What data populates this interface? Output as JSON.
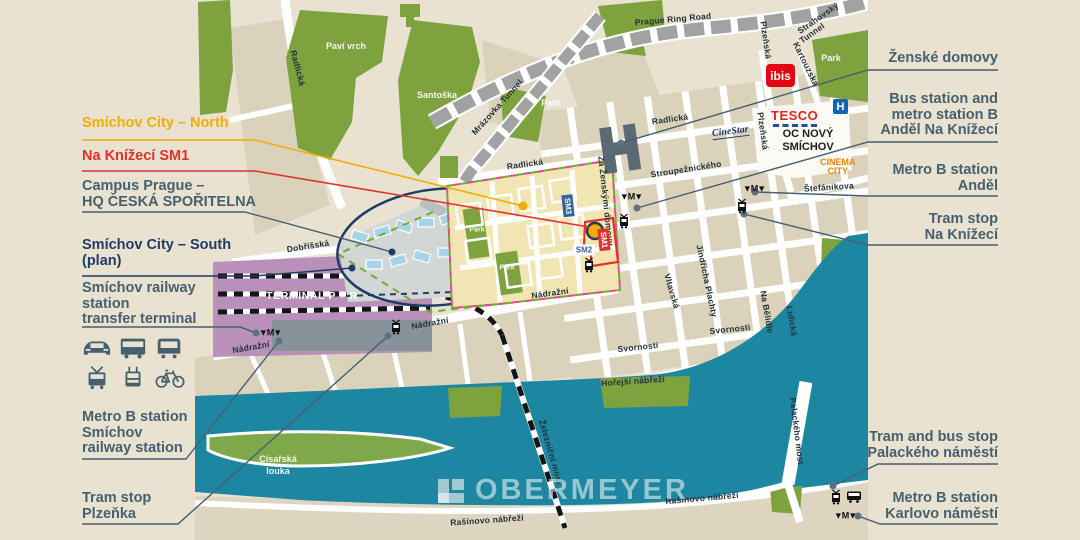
{
  "canvas": {
    "bg": "#e9e2d1"
  },
  "watermark": {
    "text": "OBERMEYER"
  },
  "colors": {
    "slate": "#46606f",
    "navy": "#1e3c64",
    "yellow": "#f0ad00",
    "red": "#e0312d",
    "river": "#1d87a2",
    "park": "#7da23e",
    "terminal": "#b890ba",
    "dev_area": "#f2e5b4"
  },
  "callouts": {
    "left": [
      {
        "id": "smichov-city-north",
        "lines": [
          "Smíchov City – North"
        ],
        "color": "#f0ad00",
        "y": 116
      },
      {
        "id": "na-knizeci-sm1",
        "lines": [
          "Na Knížecí SM1"
        ],
        "color": "#e0312d",
        "y": 149
      },
      {
        "id": "campus-prague",
        "lines": [
          "Campus Prague –",
          "HQ ČESKÁ SPOŘITELNA"
        ],
        "color": "#46606f",
        "y": 179
      },
      {
        "id": "smichov-city-south",
        "lines": [
          "Smíchov City – South",
          "(plan)"
        ],
        "color": "#1e3c64",
        "y": 238
      },
      {
        "id": "smichov-transfer-terminal",
        "lines": [
          "Smíchov railway",
          "station",
          "transfer terminal"
        ],
        "color": "#46606f",
        "y": 281
      },
      {
        "id": "metro-b-smichov",
        "lines": [
          "Metro B station",
          "Smíchov",
          "railway station"
        ],
        "color": "#46606f",
        "y": 410
      },
      {
        "id": "tram-stop-plzenka",
        "lines": [
          "Tram stop",
          "Plzeňka"
        ],
        "color": "#46606f",
        "y": 491
      }
    ],
    "right": [
      {
        "id": "zenske-domovy",
        "lines": [
          "Ženské domovy"
        ],
        "color": "#46606f",
        "y": 51
      },
      {
        "id": "bus-metro-andel-na-knizeci",
        "lines": [
          "Bus station and",
          "metro station B",
          "Anděl Na Knížecí"
        ],
        "color": "#46606f",
        "y": 92
      },
      {
        "id": "metro-b-andel",
        "lines": [
          "Metro B station",
          "Anděl"
        ],
        "color": "#46606f",
        "y": 163
      },
      {
        "id": "tram-stop-na-knizeci",
        "lines": [
          "Tram stop",
          "Na Knížecí"
        ],
        "color": "#46606f",
        "y": 212
      },
      {
        "id": "tram-bus-palackeho",
        "lines": [
          "Tram and bus stop",
          "Palackého náměstí"
        ],
        "color": "#46606f",
        "y": 430
      },
      {
        "id": "metro-b-karlovo",
        "lines": [
          "Metro B station",
          "Karlovo náměstí"
        ],
        "color": "#46606f",
        "y": 491
      }
    ]
  },
  "map": {
    "streets": [
      {
        "t": "Radlická",
        "x": 298,
        "y": 68,
        "r": 75
      },
      {
        "t": "Radlická",
        "x": 525,
        "y": 164,
        "r": -8
      },
      {
        "t": "Radlická",
        "x": 670,
        "y": 119,
        "r": -8
      },
      {
        "t": "Plzeňská",
        "x": 766,
        "y": 40,
        "r": 82
      },
      {
        "t": "Plzeňská",
        "x": 763,
        "y": 131,
        "r": 82
      },
      {
        "t": "Kartouzská",
        "x": 806,
        "y": 64,
        "r": 64
      },
      {
        "t": "Stroupežnického",
        "x": 686,
        "y": 169,
        "r": -9
      },
      {
        "t": "Štefánikova",
        "x": 829,
        "y": 187,
        "r": -4
      },
      {
        "t": "Za Ženskými domovy",
        "x": 606,
        "y": 201,
        "r": 84
      },
      {
        "t": "Vltavská",
        "x": 672,
        "y": 291,
        "r": 74
      },
      {
        "t": "Jindřicha Plachty",
        "x": 707,
        "y": 281,
        "r": 78
      },
      {
        "t": "Na Bělidle",
        "x": 767,
        "y": 312,
        "r": 80
      },
      {
        "t": "Lidická",
        "x": 792,
        "y": 321,
        "r": 80
      },
      {
        "t": "Svornosti",
        "x": 638,
        "y": 347,
        "r": -6
      },
      {
        "t": "Svornosti",
        "x": 730,
        "y": 329,
        "r": -6
      },
      {
        "t": "Hořejší nábřeží",
        "x": 633,
        "y": 381,
        "r": -4
      },
      {
        "t": "Nádražní",
        "x": 251,
        "y": 347,
        "r": -10
      },
      {
        "t": "Nádražní",
        "x": 430,
        "y": 323,
        "r": -10
      },
      {
        "t": "Nádražní",
        "x": 550,
        "y": 293,
        "r": -8
      },
      {
        "t": "Dobříšská",
        "x": 308,
        "y": 246,
        "r": -9
      },
      {
        "t": "Rašínovo nábřeží",
        "x": 487,
        "y": 520,
        "r": -4
      },
      {
        "t": "Rašínovo nábřeží",
        "x": 702,
        "y": 498,
        "r": -5
      },
      {
        "t": "Palackého most",
        "x": 797,
        "y": 431,
        "r": 83
      },
      {
        "t": "Železniční most",
        "x": 551,
        "y": 452,
        "r": 74
      },
      {
        "t": "Prague Ring Road",
        "x": 673,
        "y": 19,
        "r": -5
      },
      {
        "t": "Strahovský",
        "x": 818,
        "y": 18,
        "r": -35
      },
      {
        "t": "Tunnel",
        "x": 812,
        "y": 33,
        "r": -35
      },
      {
        "t": "Mrázovka Tunnel",
        "x": 497,
        "y": 107,
        "r": -48
      }
    ],
    "areas": [
      {
        "t": "Paví vrch",
        "x": 346,
        "y": 46
      },
      {
        "t": "Santoška",
        "x": 437,
        "y": 95
      },
      {
        "t": "Park",
        "x": 551,
        "y": 103
      },
      {
        "t": "Park",
        "x": 831,
        "y": 58
      },
      {
        "t": "Park",
        "x": 477,
        "y": 230,
        "small": true
      },
      {
        "t": "Park",
        "x": 507,
        "y": 268,
        "small": true
      },
      {
        "t": "Císařská",
        "x": 278,
        "y": 459
      },
      {
        "t": "louka",
        "x": 278,
        "y": 471
      }
    ],
    "labels": {
      "terminal": "TERMINAL P + R",
      "tesco": "TESCO",
      "oc1": "OC NOVÝ",
      "oc2": "SMÍCHOV",
      "cinema1": "CINEMA",
      "cinema2": "CITY",
      "cinestar": "CineStar",
      "ibis": "ibis",
      "hospital": "H",
      "sm1": "SM1",
      "sm2": "SM2",
      "sm3": "SM3"
    },
    "transit": [
      {
        "k": "metro",
        "x": 270,
        "y": 333
      },
      {
        "k": "metro",
        "x": 631,
        "y": 197
      },
      {
        "k": "metro",
        "x": 754,
        "y": 189
      },
      {
        "k": "metro",
        "x": 845,
        "y": 516
      },
      {
        "k": "tram",
        "x": 396,
        "y": 327
      },
      {
        "k": "tram",
        "x": 742,
        "y": 206
      },
      {
        "k": "tram",
        "x": 624,
        "y": 221
      },
      {
        "k": "tram",
        "x": 589,
        "y": 265
      },
      {
        "k": "tram",
        "x": 836,
        "y": 497
      },
      {
        "k": "bus",
        "x": 854,
        "y": 497
      }
    ]
  }
}
